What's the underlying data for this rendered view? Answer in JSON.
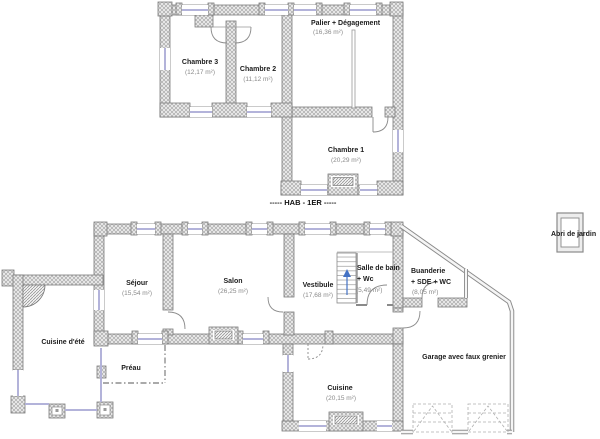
{
  "plans": {
    "first_floor": {
      "title": "----- HAB - 1ER -----",
      "rooms": [
        {
          "name": "Chambre 3",
          "area": "(12,17 m²)"
        },
        {
          "name": "Chambre 2",
          "area": "(11,12 m²)"
        },
        {
          "name": "Palier + Dégagement",
          "area": "(16,36 m²)"
        },
        {
          "name": "Chambre 1",
          "area": "(20,29 m²)"
        }
      ]
    },
    "ground_floor": {
      "rooms": [
        {
          "name": "Séjour",
          "area": "(15,54 m²)"
        },
        {
          "name": "Salon",
          "area": "(26,25 m²)"
        },
        {
          "name": "Vestibule",
          "area": "(17,68 m²)"
        },
        {
          "name": "Salle de bain",
          "name2": "+ Wc",
          "area": "(5,49 m²)"
        },
        {
          "name": "Buanderie",
          "name2": "+ SDE + WC",
          "area": "(8,05 m²)"
        },
        {
          "name": "Cuisine d'été"
        },
        {
          "name": "Préau"
        },
        {
          "name": "Cuisine",
          "area": "(20,15 m²)"
        },
        {
          "name": "Garage avec faux grenier"
        },
        {
          "name": "Abri de jardin"
        }
      ]
    }
  },
  "colors": {
    "wall_fill": "#ececec",
    "wall_outline": "#7a7a7a",
    "window": "#b3b3da",
    "room_name_text": "#1c1c1c",
    "area_text": "#8a8a8a",
    "stair_arrow": "#4472c4"
  }
}
